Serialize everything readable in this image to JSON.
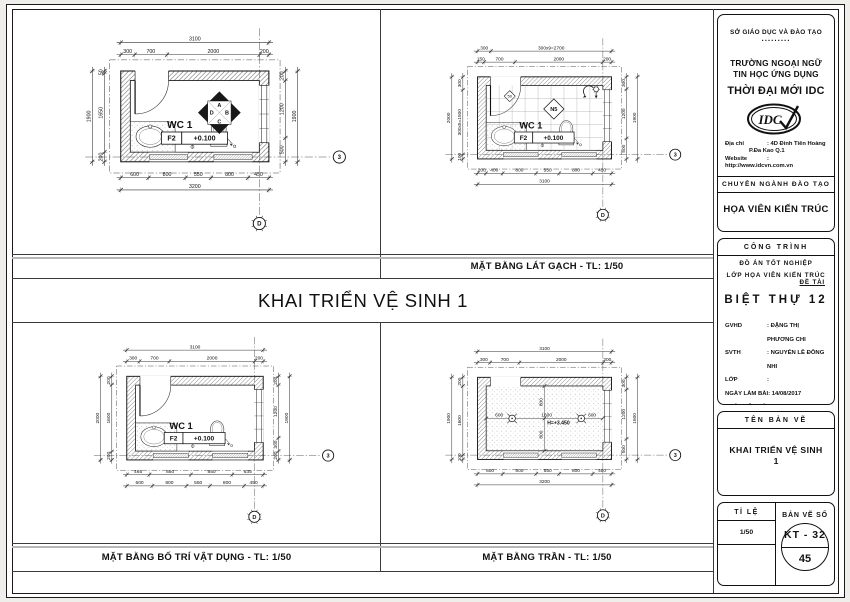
{
  "main_title": "KHAI TRIỂN VỆ SINH 1",
  "captions": {
    "top_right": "MẶT BẰNG LÁT GẠCH - TL: 1/50",
    "bottom_left": "MẶT BẰNG BỐ TRÍ VẬT DỤNG - TL: 1/50",
    "bottom_right": "MẶT BẰNG TRẦN - TL: 1/50"
  },
  "colors": {
    "paper": "#ffffff",
    "line": "#1a1a1a",
    "hatch": "#555555",
    "grayline": "#b7b7b7"
  },
  "title_block": {
    "agency": "SỞ GIÁO DỤC VÀ ĐÀO TẠO",
    "agency_dots": ".........",
    "school_line1": "TRƯỜNG NGOẠI NGỮ",
    "school_line2": "TIN HỌC ỨNG DỤNG",
    "school_name": "THỜI ĐẠI MỚI IDC",
    "logo_text": "IDC",
    "address_label": "Địa chỉ",
    "address1": ": 4D Đinh Tiên Hoàng",
    "address2": "P.Đa Kao    Q.1",
    "website_label": "Website",
    "website": ": http://www.idcvn.com.vn",
    "dept_header": "CHUYÊN NGÀNH ĐÀO TẠO",
    "dept_name": "HỌA VIÊN KIẾN TRÚC",
    "project_header": "CÔNG TRÌNH",
    "project_line1": "ĐỒ ÁN TỐT NGHIỆP",
    "project_line2": "LỚP HỌA VIÊN KIẾN TRÚC",
    "project_line3": "ĐỀ TÀI",
    "project_name": "BIỆT THỰ 12",
    "fields": [
      {
        "label": "GVHD",
        "value": ": ĐẶNG THỊ PHƯƠNG CHI"
      },
      {
        "label": "SVTH",
        "value": ": NGUYỄN LÊ ĐÔNG NHI"
      },
      {
        "label": "LỚP",
        "value": ":"
      },
      {
        "label": "NGÀY LÀM BÀI",
        "value": ":   14/08/2017"
      },
      {
        "label": "NGÀY NỘP BÀI",
        "value": ":"
      }
    ],
    "drawing_title_header": "TÊN BẢN VẼ",
    "drawing_title_line1": "KHAI TRIỂN VỆ SINH",
    "drawing_title_line2": "1",
    "scale_label": "TỈ LỆ",
    "scale_value": "1/50",
    "number_label": "BẢN VẼ SỐ",
    "number_top": "KT - 32",
    "number_bottom": "45"
  },
  "plans": {
    "top_left": {
      "room_label": "WC 1",
      "level_tag": "F2",
      "level_value": "+0.100",
      "features": {
        "door": true,
        "fixtures": true
      },
      "elevation_marker": {
        "top": "A",
        "right": "B",
        "bottom": "C",
        "left": "D"
      },
      "dims": {
        "top": [
          [
            "3100"
          ],
          [
            "300",
            "700",
            "2000",
            "200"
          ]
        ],
        "bottom": [
          [
            "600",
            "800",
            "550",
            "800",
            "450"
          ],
          [
            "3200"
          ]
        ],
        "left": [
          [
            "1900"
          ],
          [
            "50",
            "1650",
            "200"
          ]
        ],
        "right": [
          [
            "200",
            "1200",
            "500"
          ],
          [
            "1900"
          ]
        ]
      },
      "grid_bubbles": {
        "right": "3",
        "bottom": "D"
      }
    },
    "top_right": {
      "room_label": "WC 1",
      "level_tag": "F2",
      "level_value": "+0.100",
      "features": {
        "door": true,
        "fixtures": true,
        "tiles": true,
        "shower": true
      },
      "tile_marker": "N5",
      "start_marker": "50",
      "dims": {
        "top": [
          [
            "300",
            "300x9=2700"
          ],
          [
            "150",
            "700",
            "2000",
            "200"
          ]
        ],
        "bottom": [
          [
            "200",
            "400",
            "800",
            "550",
            "800",
            "450"
          ],
          [
            "3100"
          ]
        ],
        "left": [
          [
            "2000"
          ],
          [
            "300",
            "300x5=1500",
            "100"
          ]
        ],
        "right": [
          [
            "300",
            "1200",
            "500"
          ],
          [
            "1900"
          ]
        ]
      },
      "grid_bubbles": {
        "right": "3",
        "bottom": "D"
      }
    },
    "bottom_left": {
      "room_label": "WC 1",
      "level_tag": "F2",
      "level_value": "+0.100",
      "features": {
        "door": true,
        "fixtures": true
      },
      "dims": {
        "top": [
          [
            "3100"
          ],
          [
            "300",
            "700",
            "2000",
            "200"
          ]
        ],
        "bottom": [
          [
            "465",
            "850",
            "850",
            "635"
          ],
          [
            "600",
            "800",
            "550",
            "800",
            "450"
          ]
        ],
        "left": [
          [
            "2000"
          ],
          [
            "200",
            "1600",
            "200"
          ]
        ],
        "right": [
          [
            "200",
            "1200",
            "300",
            "200"
          ],
          [
            "1900"
          ]
        ]
      },
      "grid_bubbles": {
        "right": "3",
        "bottom": "D"
      }
    },
    "bottom_right": {
      "features": {
        "door": false,
        "fixtures": false,
        "ceiling": true,
        "lights": true
      },
      "ceiling": {
        "h_dims": [
          "600",
          "1600",
          "600"
        ],
        "v_dims": [
          "800",
          "800"
        ],
        "height_label": "H=+3.450"
      },
      "dims": {
        "top": [
          [
            "3100"
          ],
          [
            "300",
            "700",
            "2000",
            "200"
          ]
        ],
        "bottom": [
          [
            "600",
            "800",
            "550",
            "800",
            "450"
          ],
          [
            "3200"
          ]
        ],
        "left": [
          [
            "1900"
          ],
          [
            "200",
            "1600",
            "100"
          ]
        ],
        "right": [
          [
            "300",
            "1200",
            "500"
          ],
          [
            "1600"
          ]
        ]
      },
      "grid_bubbles": {
        "right": "3",
        "bottom": "D"
      }
    }
  }
}
